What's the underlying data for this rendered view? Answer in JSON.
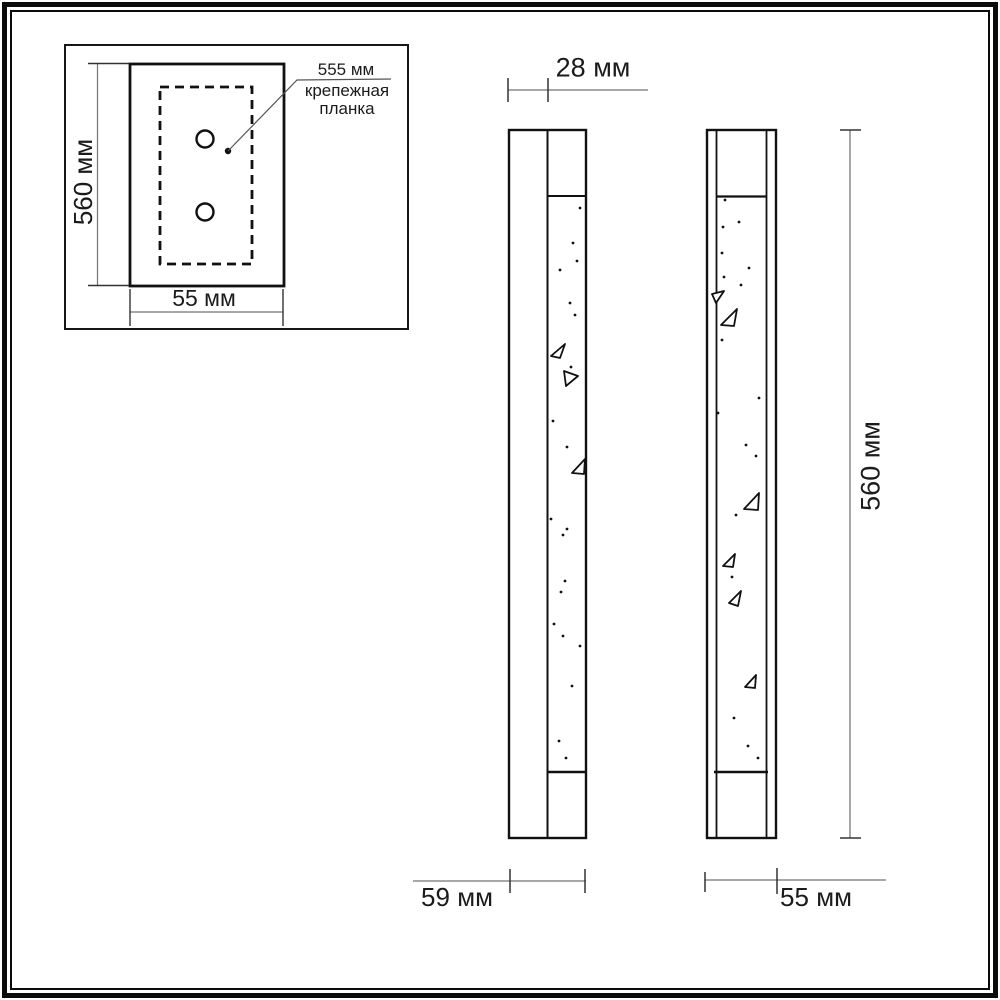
{
  "drawing": {
    "inset": {
      "height_label": "560 мм",
      "width_label": "55 мм",
      "hole_spacing_label": "555 мм",
      "mounting_plate_label": "крепежная\nпланка"
    },
    "side_view": {
      "depth_label": "28 мм",
      "width_label": "59 мм"
    },
    "front_view": {
      "height_label": "560 мм",
      "width_label": "55 мм"
    }
  },
  "colors": {
    "object_line": "#111111",
    "dimension_line": "#757575",
    "tick_line": "#333333",
    "text": "#1b1b1b",
    "background": "#ffffff",
    "frame": "#0b0b0b"
  }
}
